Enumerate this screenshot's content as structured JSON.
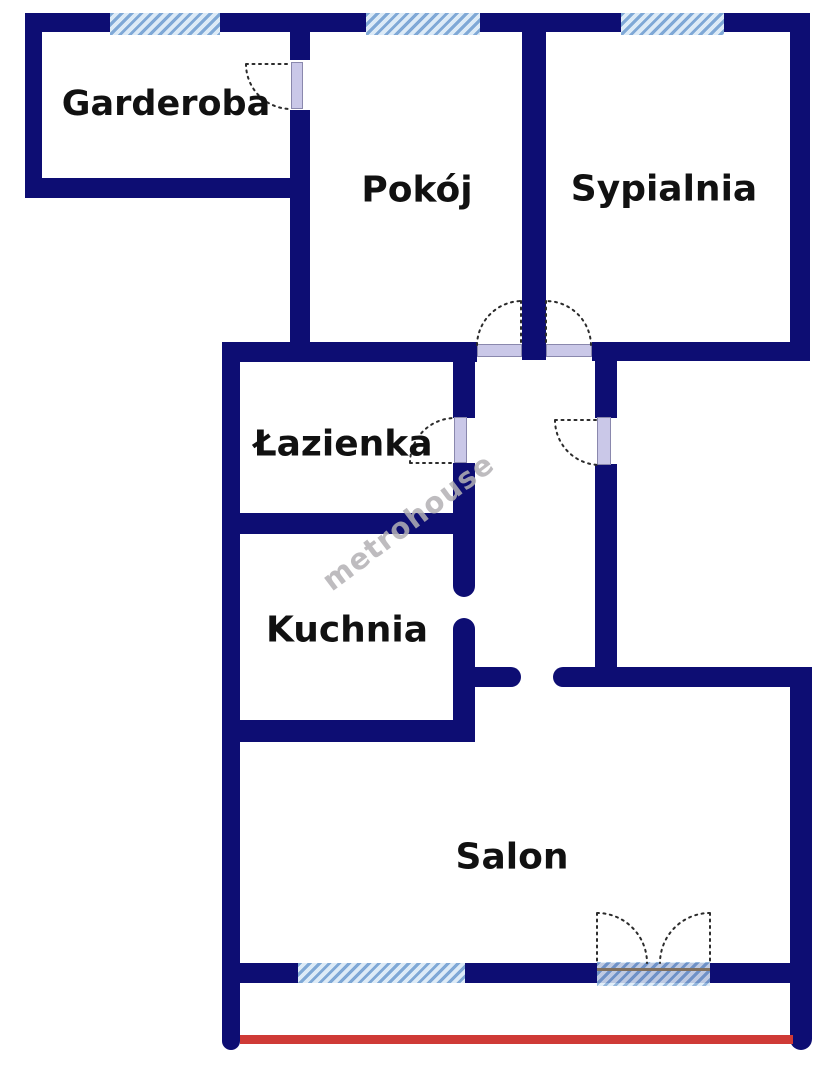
{
  "title": "Rzut mieszkania",
  "watermark": "metrohouse",
  "rooms": [
    {
      "id": "garderoba",
      "label": "Garderoba"
    },
    {
      "id": "pokoj",
      "label": "Pokój"
    },
    {
      "id": "sypialnia",
      "label": "Sypialnia"
    },
    {
      "id": "lazienka",
      "label": "Łazienka"
    },
    {
      "id": "kuchnia",
      "label": "Kuchnia"
    },
    {
      "id": "salon",
      "label": "Salon"
    }
  ],
  "colors": {
    "wall": "#0d0d73",
    "window_stripe_dark": "#7fa8d6",
    "window_stripe_light": "#ddebf7",
    "door_leaf": "#cac8e8",
    "door_leaf_edge": "#8a88ad",
    "arc_color": "#2b2b2b",
    "threshold_line": "#80705f",
    "balcony_line": "#cf3a36",
    "label": "#111111",
    "watermark": "#b3b1b5"
  }
}
